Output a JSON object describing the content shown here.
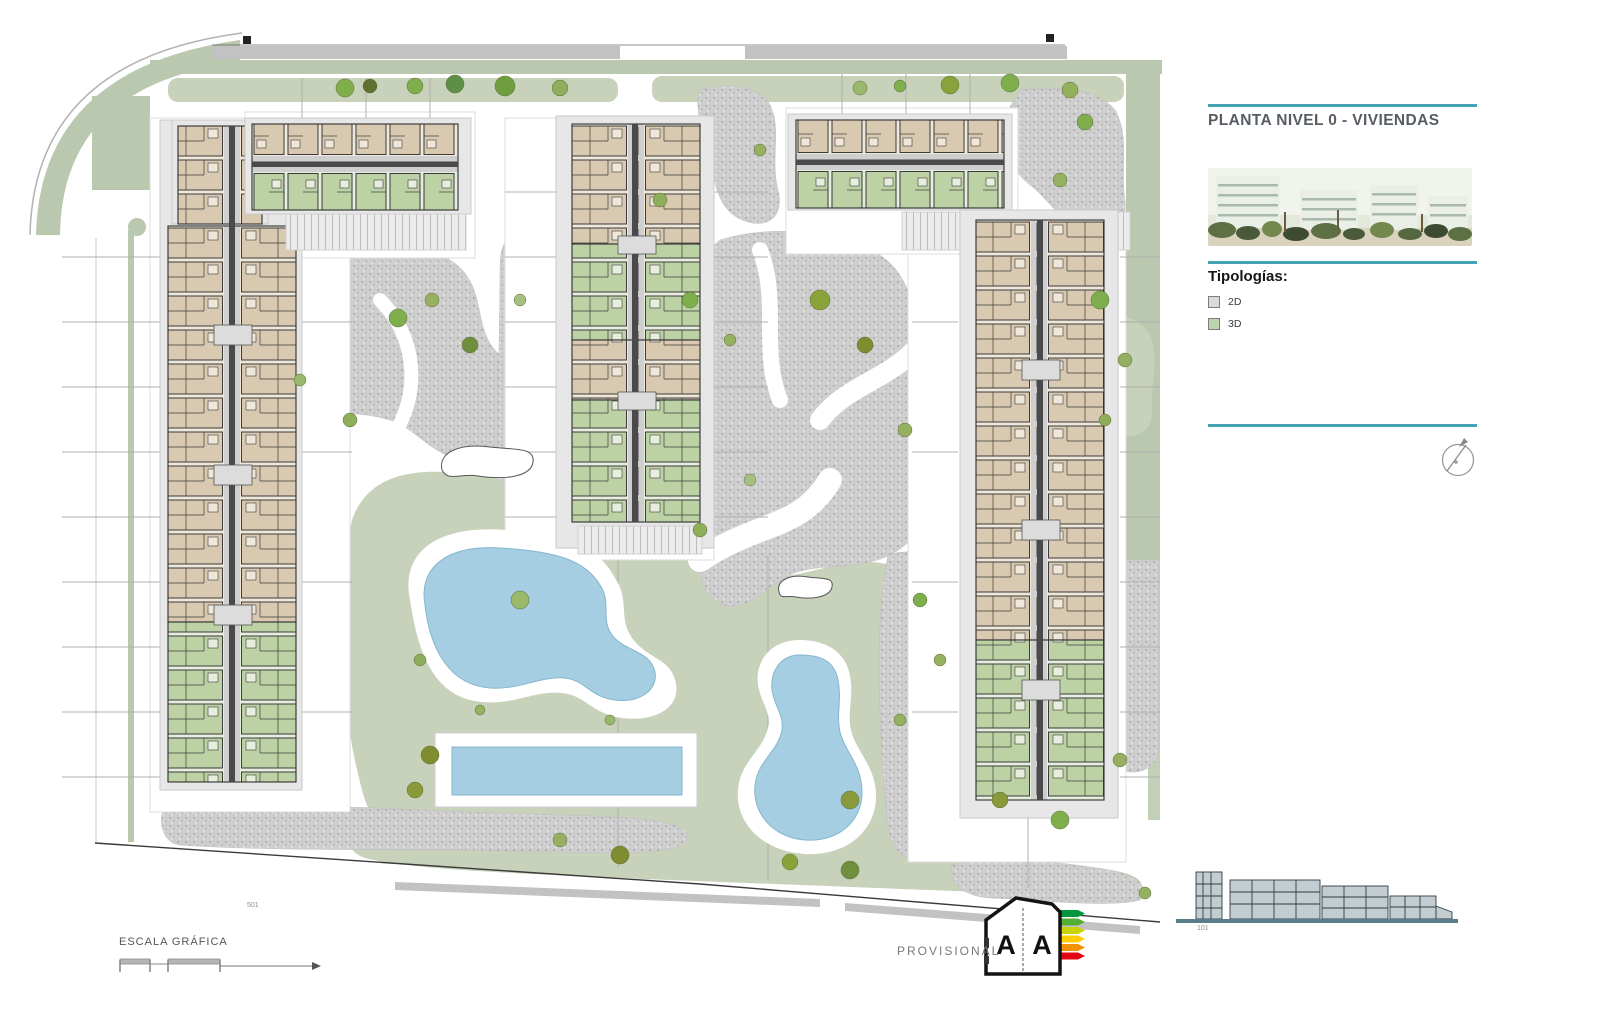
{
  "panel": {
    "title": "PLANTA NIVEL 0 - VIVIENDAS",
    "typologies_heading": "Tipologías:",
    "legend": [
      {
        "label": "2D",
        "swatch": "#d9d9d9"
      },
      {
        "label": "3D",
        "swatch": "#bdd3ab"
      }
    ]
  },
  "plan": {
    "markers": {
      "scale_ref": "501",
      "elevation_ref": "101"
    }
  },
  "footer": {
    "scale_label": "ESCALA GRÁFICA",
    "provisional_label": "PROVISIONAL",
    "energy_rating_left": "A",
    "energy_rating_right": "A"
  },
  "colors": {
    "teal_rule": "#45a3b2",
    "sage_band": "#b9c8ae",
    "lawn": "#c8d2bb",
    "gravel": "#cdcdcd",
    "pool_water": "#a5cee2",
    "unit_2d_tan": "#d9c9b0",
    "unit_3d_green": "#bcd2a4",
    "road": "#c2c2c2",
    "energy_bars": [
      "#00963f",
      "#52ae34",
      "#c8d300",
      "#ffcc00",
      "#f39200",
      "#e30613"
    ]
  }
}
